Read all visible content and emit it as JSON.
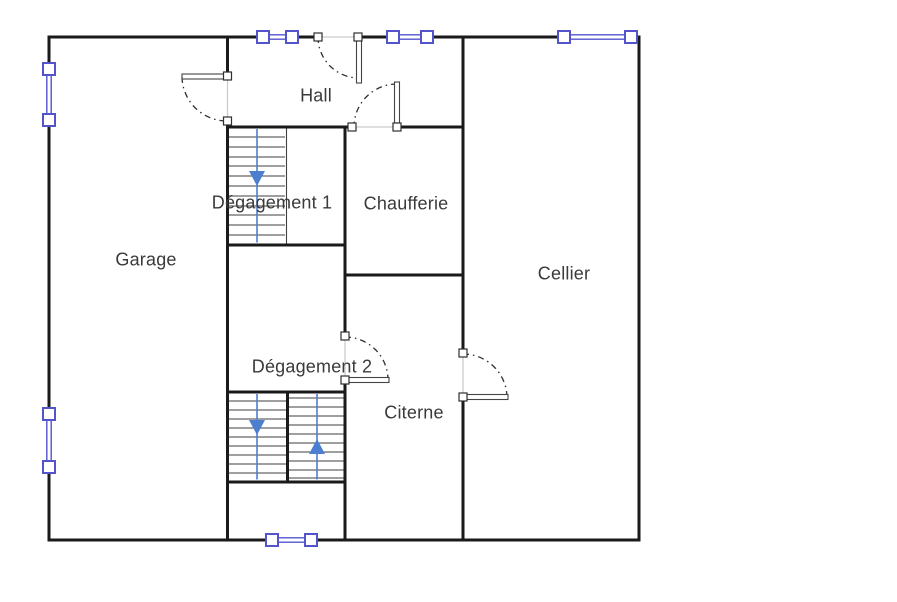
{
  "canvas": {
    "width": 897,
    "height": 602,
    "background": "#ffffff"
  },
  "rooms": [
    {
      "id": "garage",
      "name": "Garage"
    },
    {
      "id": "hall",
      "name": "Hall"
    },
    {
      "id": "degagement-1",
      "name": "Dégagement 1"
    },
    {
      "id": "chaufferie",
      "name": "Chaufferie"
    },
    {
      "id": "cellier",
      "name": "Cellier"
    },
    {
      "id": "degagement-2",
      "name": "Dégagement 2"
    },
    {
      "id": "citerne",
      "name": "Citerne"
    }
  ],
  "colors": {
    "wall": "#1a1a1a",
    "window_symbol": "#5353cb",
    "stair_arrow": "#4d7fd0",
    "door_line": "#2d2d2d",
    "opening_line": "#cccccc",
    "label_text": "#3a3a3a"
  },
  "symbols": {
    "windows": [
      {
        "icon": "window-icon",
        "wall": "top",
        "position": "left"
      },
      {
        "icon": "window-icon",
        "wall": "top",
        "position": "center"
      },
      {
        "icon": "window-icon",
        "wall": "top",
        "position": "right"
      },
      {
        "icon": "window-icon",
        "wall": "left",
        "position": "upper"
      },
      {
        "icon": "window-icon",
        "wall": "left",
        "position": "lower"
      },
      {
        "icon": "window-icon",
        "wall": "bottom",
        "position": "center"
      }
    ],
    "doors": [
      {
        "icon": "door-swing-icon",
        "between": [
          "exterior",
          "hall"
        ]
      },
      {
        "icon": "door-swing-icon",
        "between": [
          "garage",
          "hall"
        ]
      },
      {
        "icon": "door-swing-icon",
        "between": [
          "hall",
          "chaufferie"
        ]
      },
      {
        "icon": "door-swing-icon",
        "between": [
          "degagement-2",
          "citerne"
        ]
      },
      {
        "icon": "door-swing-icon",
        "between": [
          "citerne",
          "cellier"
        ]
      }
    ],
    "stairs": [
      {
        "icon": "stairs-icon",
        "location": "degagement-1",
        "flights": 1,
        "arrows": [
          "down"
        ]
      },
      {
        "icon": "stairs-icon",
        "location": "degagement-2",
        "flights": 2,
        "arrows": [
          "down",
          "up"
        ]
      }
    ]
  }
}
